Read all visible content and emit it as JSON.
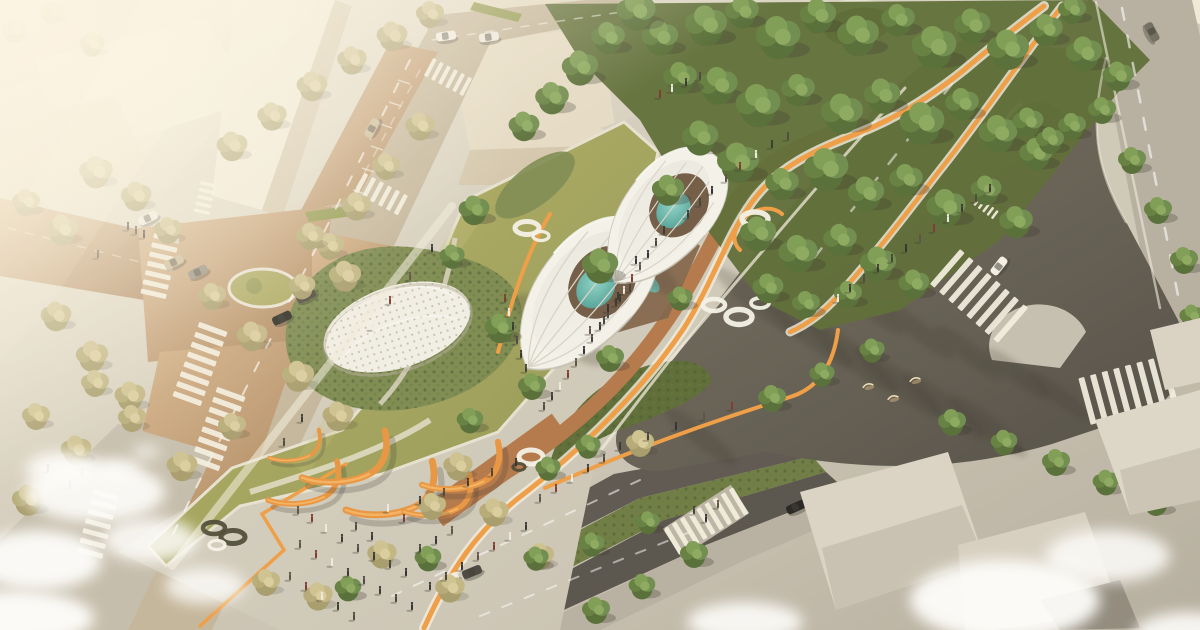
{
  "meta": {
    "alt": "Aerial architectural rendering of a triangular urban park with two white petal-shaped pavilions sheltering trees and teal pools, a white dotted dome on a green mound, winding orange cycle paths, orange sculptural arches, crowds of pedestrians, tree-lined streets with zebra crosswalks, a dark asphalt avenue with long tree shadows, dense green forest bands and hazy sunlit city blocks in the upper left"
  },
  "palette": {
    "base_light": "#e9e2d0",
    "base_dark": "#b5aea0",
    "building_light": "#f1ead9",
    "building_mid": "#e5dbc5",
    "building_shadow": "#d3c6ad",
    "road_tan_light": "#cda87d",
    "road_tan_dark": "#b08a62",
    "road_gray": "#c2b49a",
    "paver_light": "#d9d3c5",
    "cobble": "#b9b2a3",
    "asphalt_dark": "#524d45",
    "asphalt_mid": "#716a5e",
    "lawn_light": "#b3ad62",
    "lawn_dark": "#8d9549",
    "shrub_dark": "#55662f",
    "shrub_mid": "#77864a",
    "clay_path": "#b07244",
    "orange_path": "#ef9a3e",
    "orange_sculpture": "#e8913b",
    "white_structure": "#f3f2ec",
    "pool_teal": "#5fb5ab",
    "ring_white": "#f4f2ea",
    "people_dark": "#2e2d2a",
    "cloud_white": "#ffffff",
    "shadow": "#2e2a24"
  },
  "scene": {
    "trees_green": [
      [
        706,
        28,
        1.5
      ],
      [
        742,
        14,
        1.2
      ],
      [
        778,
        40,
        1.6
      ],
      [
        818,
        18,
        1.3
      ],
      [
        858,
        38,
        1.5
      ],
      [
        898,
        22,
        1.2
      ],
      [
        934,
        50,
        1.6
      ],
      [
        972,
        28,
        1.3
      ],
      [
        1008,
        52,
        1.5
      ],
      [
        1046,
        32,
        1.2
      ],
      [
        1084,
        56,
        1.3
      ],
      [
        1118,
        78,
        1.1
      ],
      [
        718,
        88,
        1.4
      ],
      [
        758,
        108,
        1.6
      ],
      [
        798,
        92,
        1.2
      ],
      [
        842,
        116,
        1.5
      ],
      [
        882,
        98,
        1.3
      ],
      [
        922,
        126,
        1.6
      ],
      [
        962,
        106,
        1.2
      ],
      [
        998,
        136,
        1.4
      ],
      [
        1036,
        156,
        1.2
      ],
      [
        1072,
        128,
        1.0
      ],
      [
        738,
        165,
        1.5
      ],
      [
        782,
        186,
        1.2
      ],
      [
        826,
        172,
        1.6
      ],
      [
        866,
        196,
        1.3
      ],
      [
        906,
        182,
        1.2
      ],
      [
        946,
        210,
        1.4
      ],
      [
        986,
        192,
        1.1
      ],
      [
        1016,
        224,
        1.2
      ],
      [
        758,
        236,
        1.3
      ],
      [
        798,
        256,
        1.4
      ],
      [
        840,
        242,
        1.2
      ],
      [
        878,
        266,
        1.3
      ],
      [
        914,
        286,
        1.1
      ],
      [
        848,
        296,
        1.0
      ],
      [
        806,
        306,
        1.0
      ],
      [
        768,
        290,
        1.1
      ],
      [
        700,
        140,
        1.3
      ],
      [
        680,
        80,
        1.2
      ],
      [
        660,
        40,
        1.3
      ],
      [
        636,
        14,
        1.4
      ],
      [
        608,
        40,
        1.2
      ],
      [
        580,
        70,
        1.3
      ],
      [
        552,
        100,
        1.2
      ],
      [
        524,
        128,
        1.1
      ],
      [
        1028,
        124,
        1.1
      ],
      [
        1050,
        142,
        1.0
      ],
      [
        1102,
        112,
        1.0
      ],
      [
        1132,
        162,
        1.0
      ],
      [
        1158,
        212,
        1.0
      ],
      [
        1184,
        262,
        1.0
      ],
      [
        1192,
        318,
        0.9
      ],
      [
        1072,
        12,
        1.0
      ],
      [
        474,
        212,
        1.1
      ],
      [
        452,
        258,
        0.9
      ],
      [
        500,
        330,
        1.1
      ],
      [
        532,
        388,
        1.0
      ],
      [
        470,
        422,
        0.95
      ],
      [
        610,
        360,
        1.0
      ],
      [
        548,
        470,
        0.9
      ],
      [
        588,
        448,
        0.9
      ],
      [
        680,
        300,
        0.9
      ],
      [
        772,
        400,
        1.0
      ],
      [
        600,
        268,
        1.3
      ],
      [
        668,
        192,
        1.15
      ],
      [
        952,
        424,
        1.0
      ],
      [
        1004,
        444,
        0.95
      ],
      [
        1056,
        464,
        1.0
      ],
      [
        1106,
        484,
        0.95
      ],
      [
        1156,
        504,
        1.0
      ],
      [
        938,
        556,
        0.95
      ],
      [
        694,
        556,
        1.0
      ],
      [
        642,
        588,
        0.95
      ],
      [
        596,
        612,
        1.0
      ],
      [
        872,
        352,
        0.9
      ],
      [
        822,
        376,
        0.9
      ],
      [
        536,
        560,
        0.9
      ],
      [
        592,
        546,
        0.9
      ],
      [
        648,
        524,
        0.85
      ],
      [
        428,
        560,
        0.95
      ],
      [
        348,
        590,
        0.95
      ]
    ],
    "trees_olive": [
      [
        96,
        174,
        1.2
      ],
      [
        136,
        198,
        1.1
      ],
      [
        62,
        232,
        1.15
      ],
      [
        26,
        204,
        1.0
      ],
      [
        168,
        232,
        1.0
      ],
      [
        232,
        148,
        1.1
      ],
      [
        272,
        118,
        1.05
      ],
      [
        312,
        88,
        1.1
      ],
      [
        352,
        62,
        1.05
      ],
      [
        392,
        38,
        1.1
      ],
      [
        430,
        16,
        1.0
      ],
      [
        56,
        318,
        1.1
      ],
      [
        92,
        358,
        1.15
      ],
      [
        130,
        398,
        1.1
      ],
      [
        36,
        418,
        1.0
      ],
      [
        76,
        452,
        1.1
      ],
      [
        28,
        502,
        1.15
      ],
      [
        212,
        298,
        1.0
      ],
      [
        252,
        338,
        1.1
      ],
      [
        298,
        378,
        1.15
      ],
      [
        338,
        418,
        1.1
      ],
      [
        232,
        428,
        1.0
      ],
      [
        182,
        468,
        1.1
      ],
      [
        420,
        128,
        1.05
      ],
      [
        386,
        168,
        1.0
      ],
      [
        356,
        208,
        1.05
      ],
      [
        330,
        248,
        1.0
      ],
      [
        302,
        288,
        0.95
      ],
      [
        458,
        468,
        1.05
      ],
      [
        432,
        508,
        1.0
      ],
      [
        494,
        514,
        1.05
      ],
      [
        382,
        556,
        1.05
      ],
      [
        318,
        598,
        1.05
      ],
      [
        266,
        584,
        1.0
      ],
      [
        450,
        590,
        1.05
      ],
      [
        540,
        558,
        1.0
      ],
      [
        345,
        278,
        1.15
      ],
      [
        310,
        238,
        1.0
      ],
      [
        95,
        385,
        1.0
      ],
      [
        132,
        420,
        1.0
      ],
      [
        14,
        32,
        0.9
      ],
      [
        52,
        14,
        0.85
      ],
      [
        92,
        46,
        0.9
      ],
      [
        640,
        445,
        1.0
      ]
    ],
    "people": [
      [
        664,
        232
      ],
      [
        656,
        244
      ],
      [
        648,
        256
      ],
      [
        640,
        268
      ],
      [
        632,
        280
      ],
      [
        624,
        292
      ],
      [
        616,
        304
      ],
      [
        608,
        316
      ],
      [
        600,
        328
      ],
      [
        592,
        340
      ],
      [
        584,
        352
      ],
      [
        576,
        364
      ],
      [
        568,
        376
      ],
      [
        560,
        388
      ],
      [
        552,
        398
      ],
      [
        544,
        408
      ],
      [
        620,
        300
      ],
      [
        604,
        322
      ],
      [
        636,
        262
      ],
      [
        590,
        332
      ],
      [
        505,
        300
      ],
      [
        509,
        314
      ],
      [
        513,
        328
      ],
      [
        517,
        342
      ],
      [
        521,
        356
      ],
      [
        526,
        370
      ],
      [
        432,
        250
      ],
      [
        410,
        278
      ],
      [
        390,
        302
      ],
      [
        372,
        328
      ],
      [
        302,
        420
      ],
      [
        284,
        444
      ],
      [
        688,
        216
      ],
      [
        700,
        204
      ],
      [
        712,
        192
      ],
      [
        726,
        180
      ],
      [
        740,
        168
      ],
      [
        756,
        156
      ],
      [
        772,
        146
      ],
      [
        788,
        138
      ],
      [
        618,
        298
      ],
      [
        630,
        290
      ],
      [
        608,
        310
      ],
      [
        298,
        512
      ],
      [
        312,
        520
      ],
      [
        326,
        530
      ],
      [
        342,
        540
      ],
      [
        358,
        550
      ],
      [
        374,
        558
      ],
      [
        390,
        566
      ],
      [
        406,
        574
      ],
      [
        300,
        546
      ],
      [
        316,
        556
      ],
      [
        332,
        564
      ],
      [
        348,
        574
      ],
      [
        364,
        582
      ],
      [
        380,
        592
      ],
      [
        396,
        600
      ],
      [
        412,
        608
      ],
      [
        290,
        578
      ],
      [
        306,
        588
      ],
      [
        322,
        598
      ],
      [
        338,
        608
      ],
      [
        354,
        618
      ],
      [
        430,
        588
      ],
      [
        446,
        578
      ],
      [
        462,
        568
      ],
      [
        478,
        558
      ],
      [
        494,
        548
      ],
      [
        510,
        538
      ],
      [
        526,
        528
      ],
      [
        356,
        528
      ],
      [
        372,
        538
      ],
      [
        420,
        550
      ],
      [
        436,
        542
      ],
      [
        452,
        532
      ],
      [
        404,
        520
      ],
      [
        388,
        510
      ],
      [
        420,
        502
      ],
      [
        444,
        494
      ],
      [
        468,
        484
      ],
      [
        492,
        474
      ],
      [
        516,
        464
      ],
      [
        540,
        500
      ],
      [
        556,
        490
      ],
      [
        572,
        480
      ],
      [
        588,
        470
      ],
      [
        604,
        460
      ],
      [
        620,
        448
      ],
      [
        648,
        438
      ],
      [
        676,
        428
      ],
      [
        704,
        418
      ],
      [
        732,
        408
      ],
      [
        838,
        300
      ],
      [
        850,
        290
      ],
      [
        864,
        280
      ],
      [
        878,
        270
      ],
      [
        892,
        260
      ],
      [
        906,
        250
      ],
      [
        920,
        240
      ],
      [
        934,
        230
      ],
      [
        948,
        220
      ],
      [
        962,
        210
      ],
      [
        976,
        200
      ],
      [
        990,
        190
      ],
      [
        694,
        512
      ],
      [
        706,
        520
      ],
      [
        718,
        506
      ],
      [
        48,
        470
      ],
      [
        58,
        478
      ],
      [
        70,
        486
      ],
      [
        82,
        474
      ],
      [
        128,
        228
      ],
      [
        136,
        232
      ],
      [
        144,
        236
      ],
      [
        98,
        256
      ],
      [
        660,
        96
      ],
      [
        672,
        90
      ],
      [
        686,
        84
      ],
      [
        700,
        78
      ]
    ],
    "cars": [
      [
        148,
        218,
        -25,
        "#f0ece1"
      ],
      [
        174,
        262,
        -25,
        "#c7b591"
      ],
      [
        198,
        272,
        -25,
        "#8e8577"
      ],
      [
        306,
        296,
        -25,
        "#4d463c"
      ],
      [
        282,
        318,
        -25,
        "#24221e"
      ],
      [
        446,
        36,
        -8,
        "#f2eee4"
      ],
      [
        489,
        37,
        -8,
        "#eeeade"
      ],
      [
        372,
        128,
        -62,
        "#c9b994"
      ],
      [
        449,
        579,
        -22,
        "#f1ede2"
      ],
      [
        472,
        572,
        -22,
        "#413e39"
      ],
      [
        999,
        266,
        -52,
        "#f3f0e6"
      ],
      [
        1152,
        32,
        62,
        "#6c665c"
      ],
      [
        796,
        507,
        -24,
        "#1c1b19"
      ]
    ],
    "rings": [
      [
        527,
        228,
        12,
        6.5,
        "w"
      ],
      [
        541,
        236,
        8,
        4.5,
        "w"
      ],
      [
        755,
        219,
        13,
        7,
        "w"
      ],
      [
        714,
        305,
        11,
        6,
        "w"
      ],
      [
        739,
        317,
        13,
        7.5,
        "w"
      ],
      [
        760,
        303,
        9,
        5,
        "w"
      ],
      [
        531,
        457,
        12,
        7,
        "w"
      ],
      [
        547,
        467,
        9,
        5,
        "w"
      ],
      [
        519,
        467,
        6,
        3.5,
        "d"
      ],
      [
        214,
        528,
        11,
        6,
        "d"
      ],
      [
        233,
        537,
        12,
        6.5,
        "d"
      ],
      [
        217,
        545,
        8,
        4.5,
        "w"
      ]
    ],
    "crosswalks": [
      [
        160,
        266,
        103,
        7,
        26,
        5,
        4.5
      ],
      [
        200,
        364,
        110,
        8,
        30,
        5.5,
        5
      ],
      [
        218,
        429,
        110,
        8,
        30,
        5.5,
        5
      ],
      [
        98,
        524,
        105,
        7,
        26,
        5,
        5
      ],
      [
        381,
        194,
        28,
        6,
        22,
        4.5,
        4.5
      ],
      [
        448,
        77,
        28,
        6,
        20,
        4,
        4
      ],
      [
        205,
        198,
        103,
        5,
        16,
        3.5,
        3.5
      ],
      [
        979,
        296,
        41,
        8,
        46,
        6,
        6
      ],
      [
        1128,
        390,
        -15,
        8,
        48,
        6,
        6
      ],
      [
        706,
        521,
        -31,
        9,
        30,
        5,
        4.5
      ],
      [
        986,
        208,
        37,
        5,
        10,
        2.5,
        3
      ]
    ],
    "arches": [
      [
        308,
        492,
        1.0
      ],
      [
        350,
        468,
        1.2
      ],
      [
        396,
        500,
        1.25
      ],
      [
        442,
        504,
        0.95
      ],
      [
        466,
        476,
        1.1
      ],
      [
        298,
        452,
        0.72
      ]
    ],
    "birds": [
      [
        868,
        386
      ],
      [
        893,
        398
      ],
      [
        915,
        380
      ]
    ],
    "clouds": [
      [
        95,
        492,
        70,
        30,
        0.92
      ],
      [
        38,
        560,
        64,
        30,
        0.95
      ],
      [
        150,
        540,
        48,
        22,
        0.85
      ],
      [
        12,
        618,
        82,
        28,
        0.96
      ],
      [
        205,
        586,
        40,
        18,
        0.8
      ],
      [
        62,
        468,
        36,
        16,
        0.9
      ],
      [
        118,
        470,
        22,
        10,
        0.8
      ],
      [
        146,
        452,
        14,
        7,
        0.7
      ],
      [
        1005,
        600,
        95,
        40,
        0.95
      ],
      [
        1108,
        556,
        62,
        26,
        0.85
      ],
      [
        745,
        622,
        58,
        20,
        0.9
      ],
      [
        1190,
        634,
        56,
        22,
        0.9
      ]
    ],
    "shadow_streaks": [
      [
        758,
        302,
        55,
        11,
        38
      ],
      [
        806,
        330,
        58,
        12,
        38
      ],
      [
        852,
        356,
        58,
        12,
        38
      ],
      [
        898,
        382,
        55,
        11,
        38
      ],
      [
        944,
        406,
        52,
        11,
        38
      ],
      [
        988,
        426,
        48,
        10,
        38
      ],
      [
        868,
        306,
        45,
        9,
        38
      ],
      [
        918,
        330,
        45,
        9,
        38
      ],
      [
        968,
        352,
        42,
        9,
        38
      ],
      [
        1018,
        374,
        40,
        9,
        38
      ],
      [
        700,
        436,
        45,
        10,
        38
      ],
      [
        1060,
        396,
        38,
        8,
        38
      ]
    ]
  }
}
